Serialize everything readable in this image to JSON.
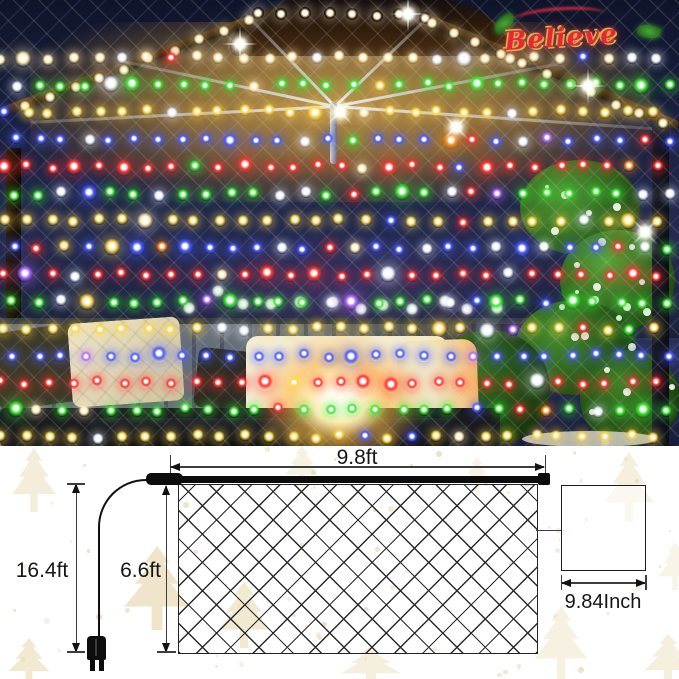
{
  "photo": {
    "sign_text": "Believe",
    "sky_color": "#1a2140",
    "roof_color": "#b98a45",
    "palette": {
      "red": "#ff3230",
      "green": "#3fe636",
      "yellow": "#ffd84d",
      "blue": "#4a5aff",
      "warmwhite": "#ffe9ae",
      "white": "#eef2ff",
      "orange": "#ff8c1a",
      "purple": "#b06bff"
    },
    "rows": [
      {
        "y": 58,
        "color": "warmwhite"
      },
      {
        "y": 85,
        "color": "green"
      },
      {
        "y": 112,
        "color": "yellow"
      },
      {
        "y": 140,
        "color": "blue"
      },
      {
        "y": 167,
        "color": "red"
      },
      {
        "y": 194,
        "color": "green"
      },
      {
        "y": 221,
        "color": "yellow"
      },
      {
        "y": 248,
        "color": "blue"
      },
      {
        "y": 275,
        "color": "red"
      },
      {
        "y": 302,
        "color": "green"
      },
      {
        "y": 329,
        "color": "yellow"
      },
      {
        "y": 356,
        "color": "blue"
      },
      {
        "y": 383,
        "color": "red"
      },
      {
        "y": 410,
        "color": "green"
      },
      {
        "y": 437,
        "color": "yellow"
      }
    ],
    "cols": 28,
    "spacing": 24.2
  },
  "diagram": {
    "width_label": "9.8ft",
    "height_label": "6.6ft",
    "total_length_label": "16.4ft",
    "mesh_label": "9.84Inch",
    "line_color": "#1c1c1c",
    "background": "#ffffff",
    "watermark_color": "#ecdfbd"
  }
}
